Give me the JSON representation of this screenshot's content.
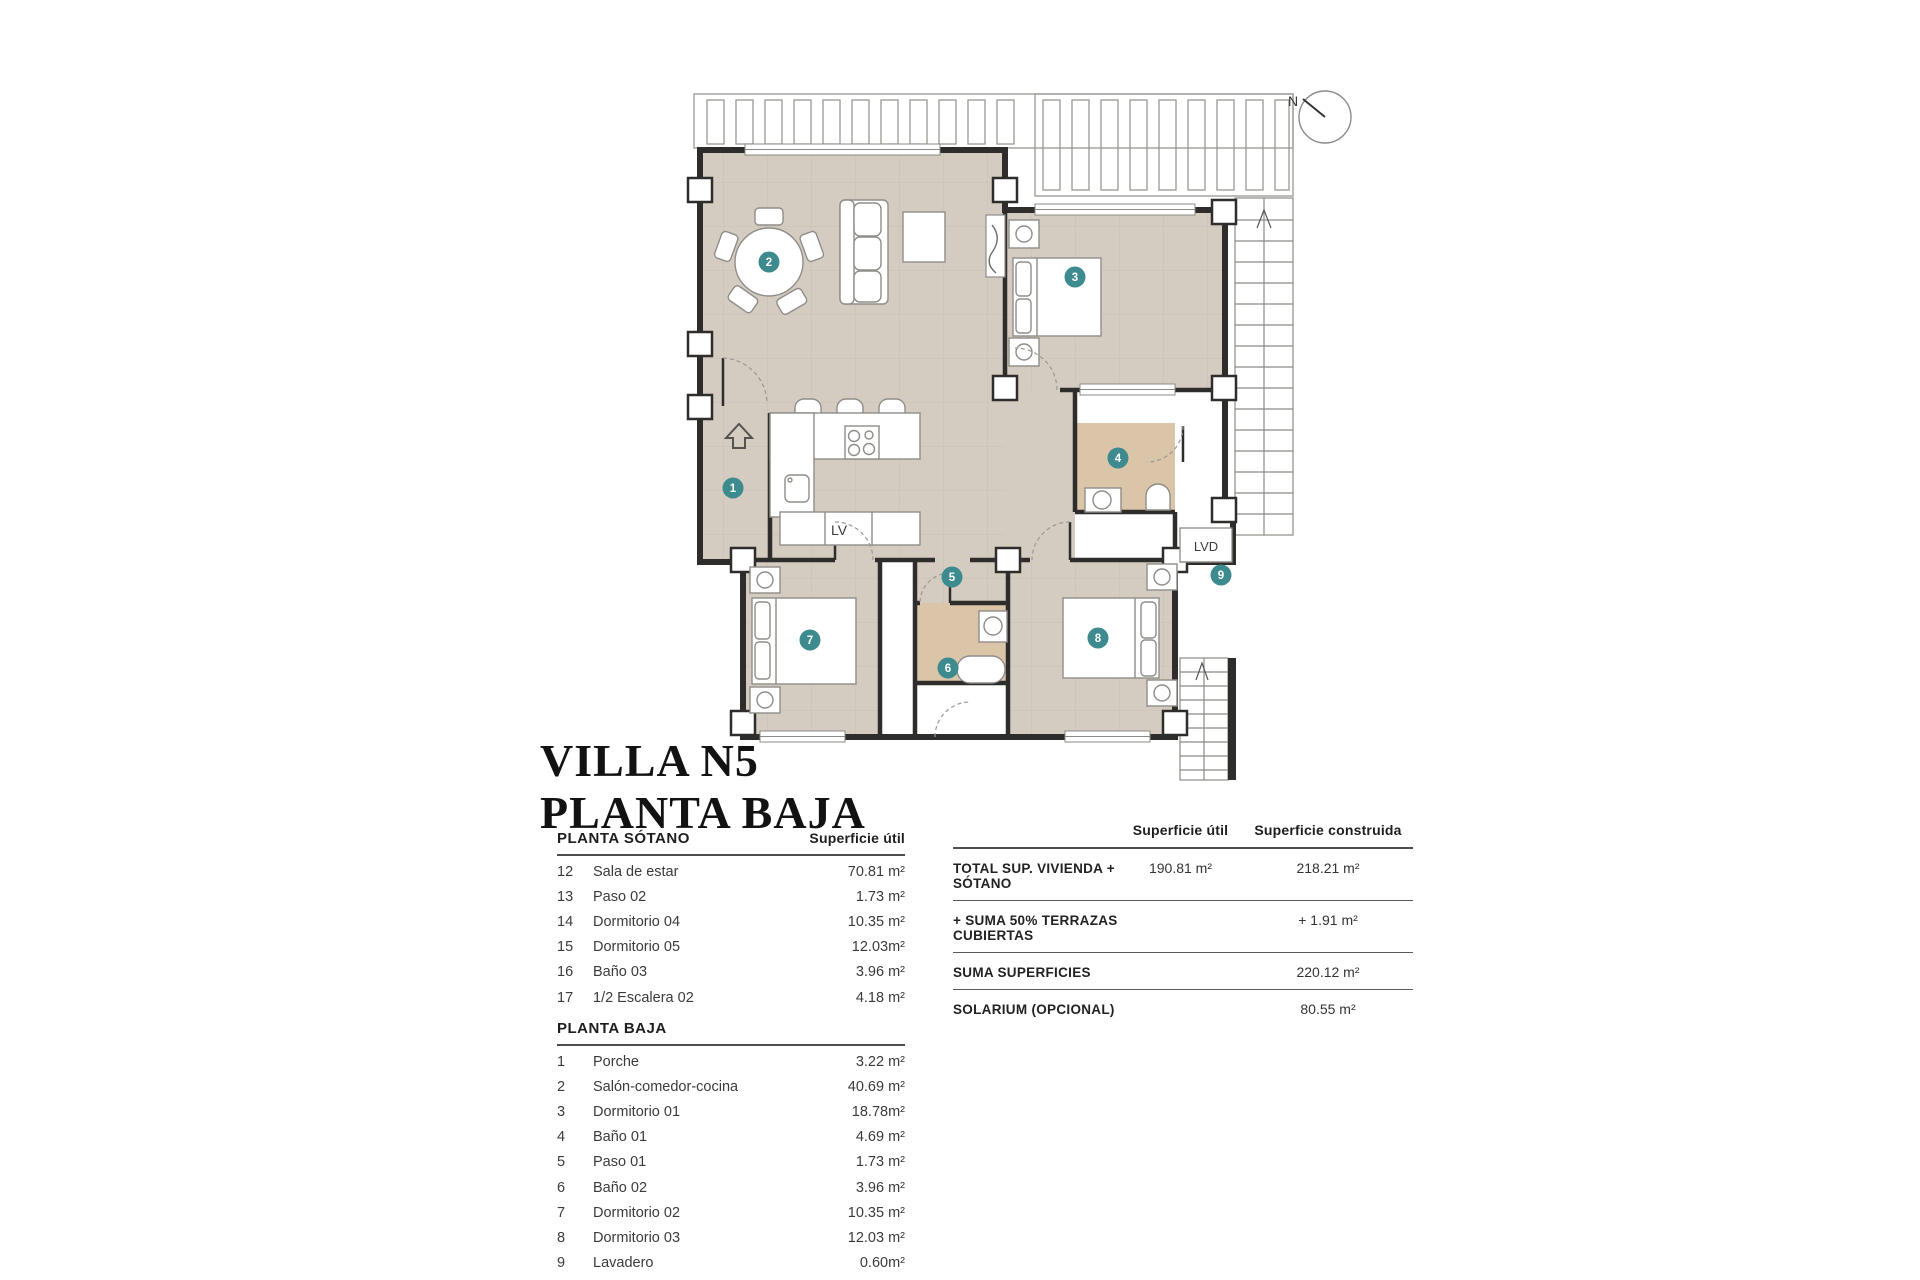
{
  "title": {
    "line1": "VILLA N5",
    "line2": "PLANTA BAJA"
  },
  "plan": {
    "north_label": "N",
    "kitchen_label": "LV",
    "laundry_label": "LVD",
    "markers": [
      "1",
      "2",
      "3",
      "4",
      "5",
      "6",
      "7",
      "8",
      "9"
    ],
    "colors": {
      "accent_teal": "#3d8b8e",
      "floor_beige": "#d4ccc1",
      "bath_tan": "#dac5a9",
      "wall_dark": "#2f2d2b"
    }
  },
  "left_table": {
    "sotano": {
      "header": "PLANTA SÓTANO",
      "value_header": "Superficie útil",
      "rows": [
        {
          "num": "12",
          "name": "Sala de estar",
          "value": "70.81 m²"
        },
        {
          "num": "13",
          "name": "Paso 02",
          "value": "1.73 m²"
        },
        {
          "num": "14",
          "name": "Dormitorio 04",
          "value": "10.35 m²"
        },
        {
          "num": "15",
          "name": "Dormitorio 05",
          "value": "12.03m²"
        },
        {
          "num": "16",
          "name": "Baño 03",
          "value": "3.96 m²"
        },
        {
          "num": "17",
          "name": "1/2 Escalera 02",
          "value": "4.18 m²"
        }
      ]
    },
    "baja": {
      "header": "PLANTA BAJA",
      "rows": [
        {
          "num": "1",
          "name": "Porche",
          "value": "3.22 m²"
        },
        {
          "num": "2",
          "name": "Salón-comedor-cocina",
          "value": "40.69 m²"
        },
        {
          "num": "3",
          "name": "Dormitorio 01",
          "value": "18.78m²"
        },
        {
          "num": "4",
          "name": "Baño 01",
          "value": "4.69 m²"
        },
        {
          "num": "5",
          "name": "Paso 01",
          "value": "1.73 m²"
        },
        {
          "num": "6",
          "name": "Baño 02",
          "value": "3.96 m²"
        },
        {
          "num": "7",
          "name": "Dormitorio 02",
          "value": "10.35 m²"
        },
        {
          "num": "8",
          "name": "Dormitorio 03",
          "value": "12.03 m²"
        },
        {
          "num": "9",
          "name": "Lavadero",
          "value": "0.60m²"
        }
      ]
    },
    "cubierta": {
      "header": "PLANTA CUBIERTA"
    }
  },
  "summary_table": {
    "col_util": "Superficie útil",
    "col_constr": "Superficie construida",
    "rows": [
      {
        "label": "TOTAL SUP. VIVIENDA + SÓTANO",
        "util": "190.81 m²",
        "constr": "218.21 m²"
      },
      {
        "label": "+ SUMA 50% TERRAZAS CUBIERTAS",
        "util": "",
        "constr": "+ 1.91 m²"
      },
      {
        "label": "SUMA SUPERFICIES",
        "util": "",
        "constr": "220.12 m²"
      },
      {
        "label": "SOLARIUM (OPCIONAL)",
        "util": "",
        "constr": "80.55 m²"
      }
    ]
  }
}
